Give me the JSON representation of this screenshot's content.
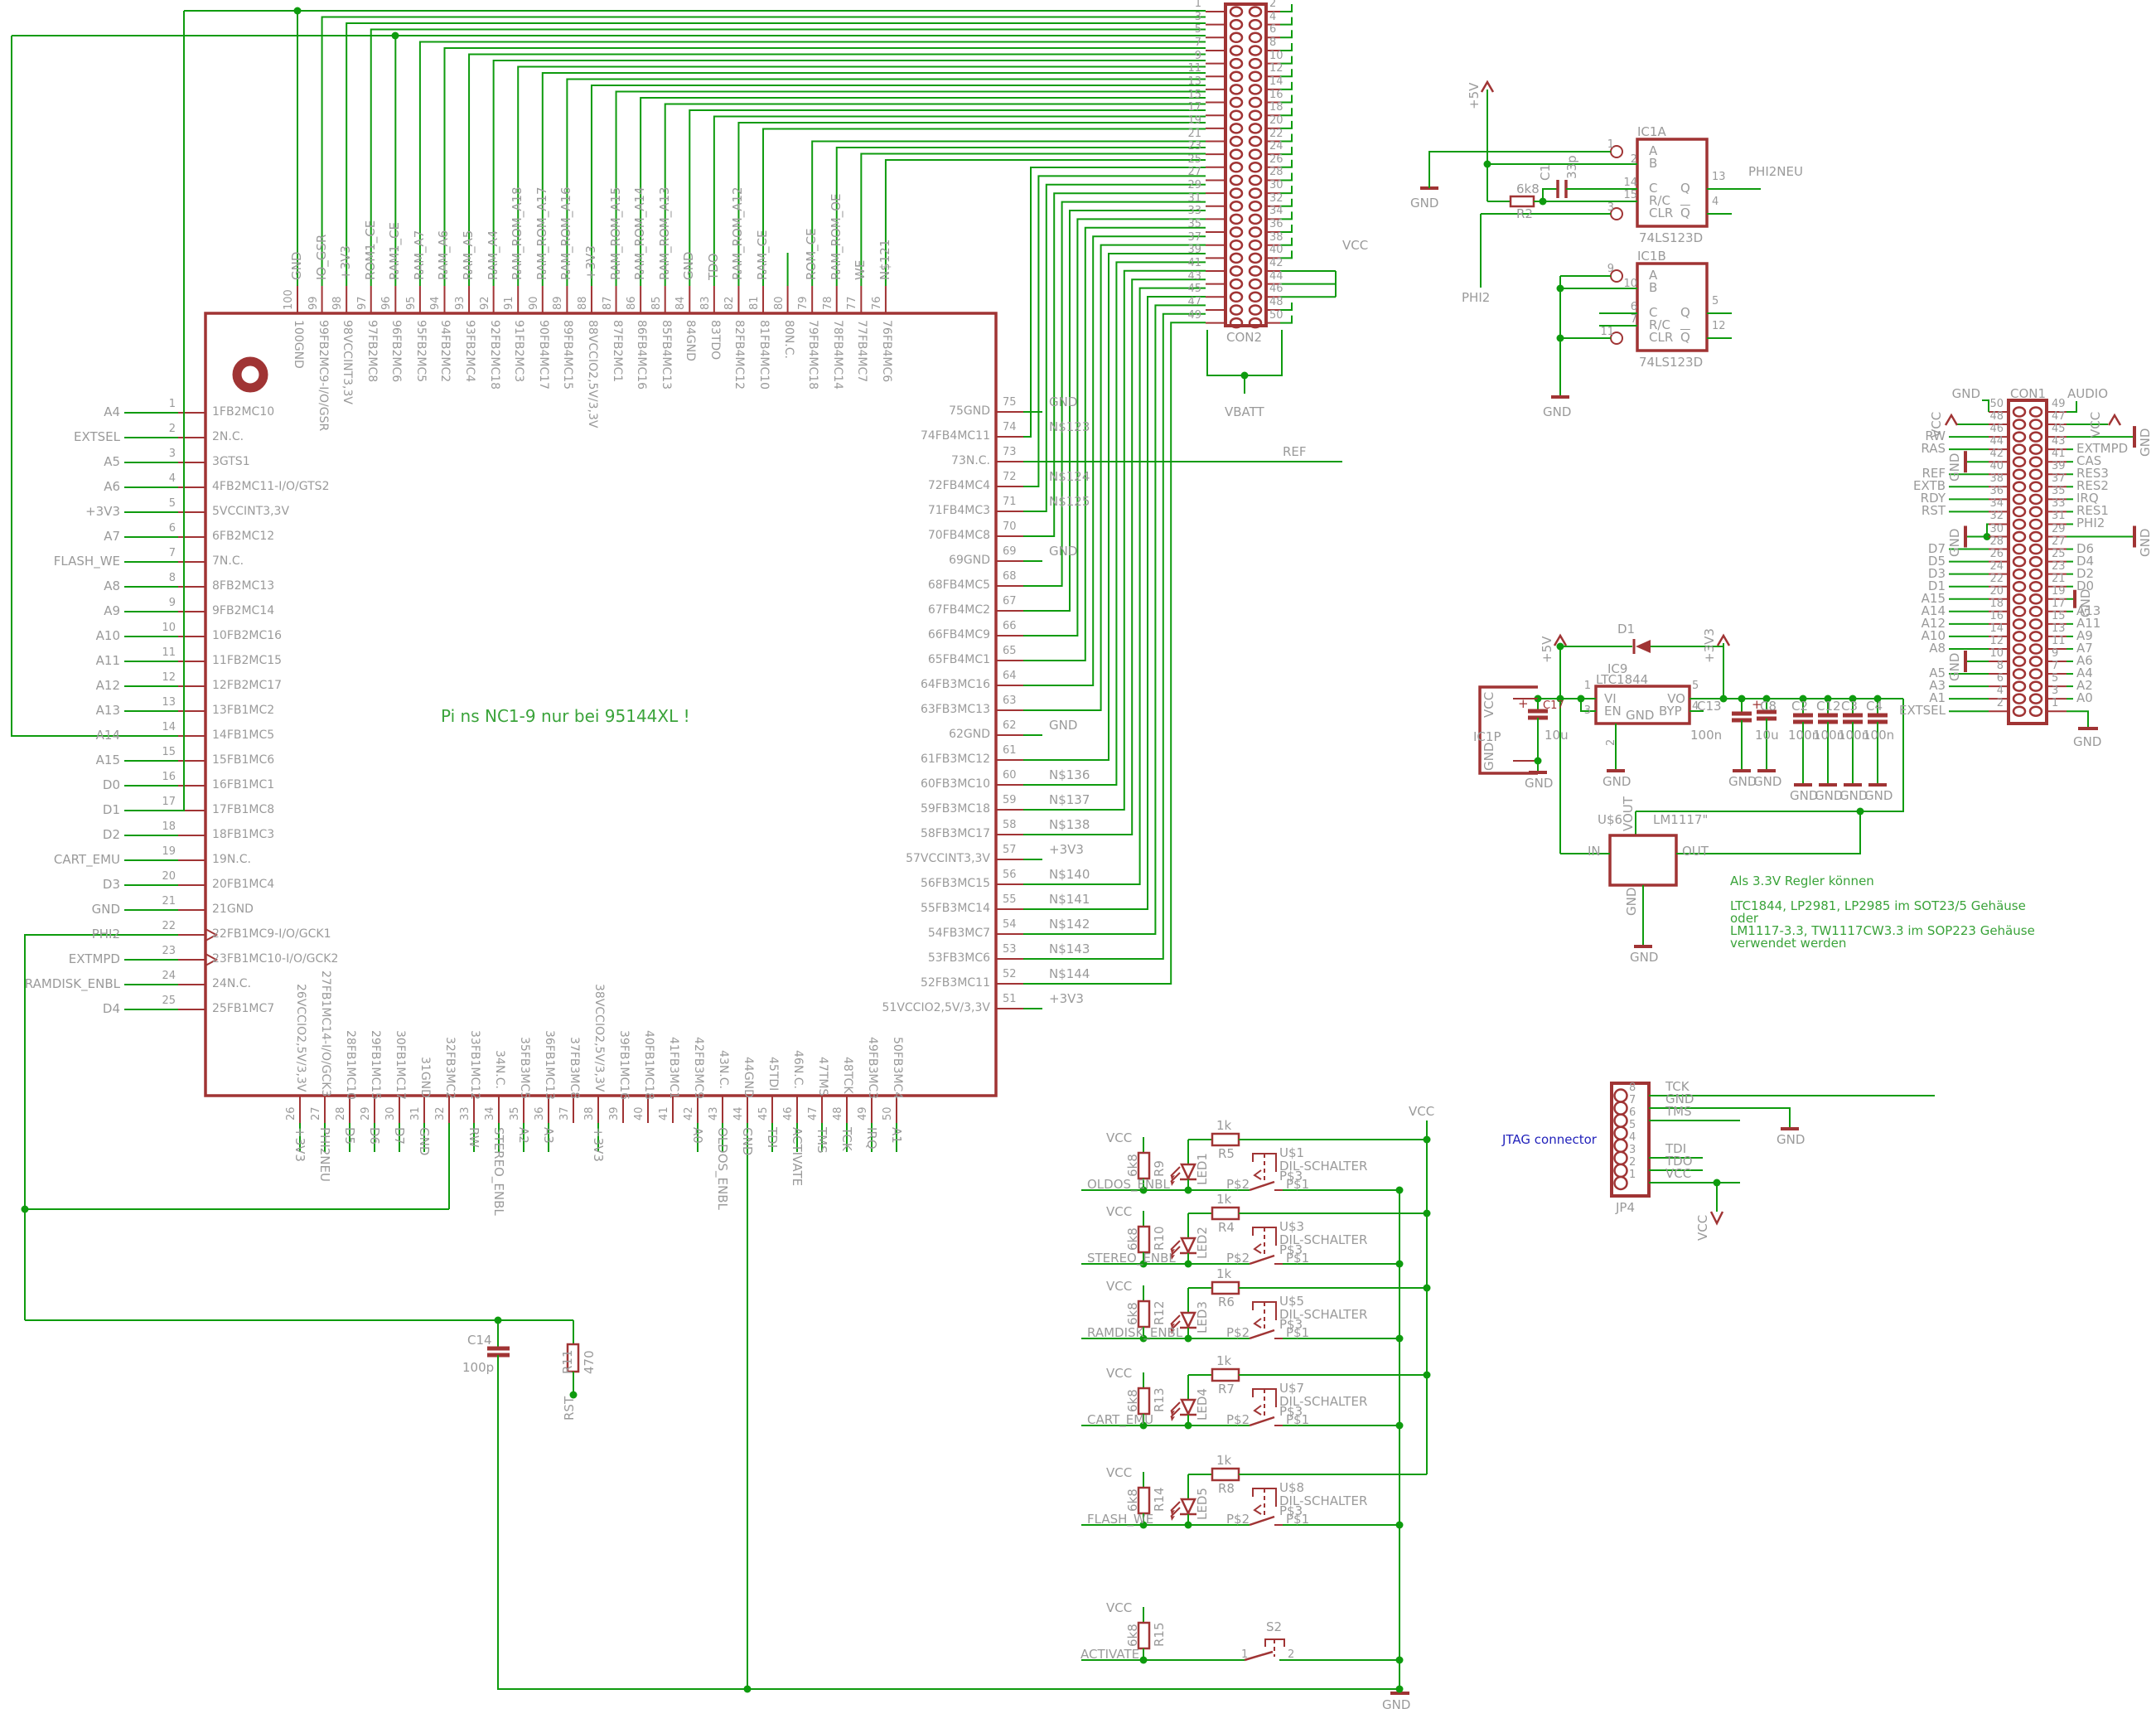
{
  "power": {
    "vcc": "VCC",
    "gnd": "GND",
    "p3v3": "+3V3",
    "p5v": "+5V",
    "vbatt": "VBATT",
    "ref": "REF"
  },
  "notes": {
    "chip": "Pi ns NC1-9 nur bei 95144XL !",
    "jtag": "JTAG connector",
    "reg1": "Als 3.3V Regler können",
    "reg2": "LTC1844, LP2981, LP2985 im SOT23/5 Gehäuse",
    "reg3": "oder",
    "reg4": "LM1117-3.3, TW1117CW3.3 im SOP223 Gehäuse",
    "reg5": "verwendet werden"
  },
  "chip": {
    "left_pins": [
      {
        "n": "1",
        "name": "1FB2MC10",
        "label": "A4"
      },
      {
        "n": "2",
        "name": "2N.C.",
        "label": "EXTSEL"
      },
      {
        "n": "3",
        "name": "3GTS1",
        "label": "A5"
      },
      {
        "n": "4",
        "name": "4FB2MC11-I/O/GTS2",
        "label": "A6"
      },
      {
        "n": "5",
        "name": "5VCCINT3,3V",
        "label": "+3V3"
      },
      {
        "n": "6",
        "name": "6FB2MC12",
        "label": "A7"
      },
      {
        "n": "7",
        "name": "7N.C.",
        "label": "FLASH_WE"
      },
      {
        "n": "8",
        "name": "8FB2MC13",
        "label": "A8"
      },
      {
        "n": "9",
        "name": "9FB2MC14",
        "label": "A9"
      },
      {
        "n": "10",
        "name": "10FB2MC16",
        "label": "A10"
      },
      {
        "n": "11",
        "name": "11FB2MC15",
        "label": "A11"
      },
      {
        "n": "12",
        "name": "12FB2MC17",
        "label": "A12"
      },
      {
        "n": "13",
        "name": "13FB1MC2",
        "label": "A13"
      },
      {
        "n": "14",
        "name": "14FB1MC5",
        "label": "A14"
      },
      {
        "n": "15",
        "name": "15FB1MC6",
        "label": "A15"
      },
      {
        "n": "16",
        "name": "16FB1MC1",
        "label": "D0"
      },
      {
        "n": "17",
        "name": "17FB1MC8",
        "label": "D1"
      },
      {
        "n": "18",
        "name": "18FB1MC3",
        "label": "D2"
      },
      {
        "n": "19",
        "name": "19N.C.",
        "label": "CART_EMU"
      },
      {
        "n": "20",
        "name": "20FB1MC4",
        "label": "D3"
      },
      {
        "n": "21",
        "name": "21GND",
        "label": "GND"
      },
      {
        "n": "22",
        "name": "22FB1MC9-I/O/GCK1",
        "label": "PHI2"
      },
      {
        "n": "23",
        "name": "23FB1MC10-I/O/GCK2",
        "label": "EXTMPD"
      },
      {
        "n": "24",
        "name": "24N.C.",
        "label": "RAMDISK_ENBL"
      },
      {
        "n": "25",
        "name": "25FB1MC7",
        "label": "D4"
      }
    ],
    "top_pins": [
      {
        "n": "100",
        "name": "100GND",
        "label": "GND"
      },
      {
        "n": "99",
        "name": "99FB2MC9-I/O/GSR",
        "label": "IO_GSR"
      },
      {
        "n": "98",
        "name": "98VCCINT3,3V",
        "label": "+3V3"
      },
      {
        "n": "97",
        "name": "97FB2MC8",
        "label": "ROM1_CE"
      },
      {
        "n": "96",
        "name": "96FB2MC6",
        "label": "RAM1_CE"
      },
      {
        "n": "95",
        "name": "95FB2MC5",
        "label": "RAM_A7"
      },
      {
        "n": "94",
        "name": "94FB2MC2",
        "label": "RAM_A6"
      },
      {
        "n": "93",
        "name": "93FB2MC4",
        "label": "RAM_A5"
      },
      {
        "n": "92",
        "name": "92FB2MC18",
        "label": "RAM_A4"
      },
      {
        "n": "91",
        "name": "91FB2MC3",
        "label": "RAM_ROM_A18"
      },
      {
        "n": "90",
        "name": "90FB4MC17",
        "label": "RAM_ROM_A17"
      },
      {
        "n": "89",
        "name": "89FB4MC15",
        "label": "RAM_ROM_A16"
      },
      {
        "n": "88",
        "name": "88VCCIO2,5V/3,3V",
        "label": "+3V3"
      },
      {
        "n": "87",
        "name": "87FB2MC1",
        "label": "RAM_ROM_A15"
      },
      {
        "n": "86",
        "name": "86FB4MC16",
        "label": "RAM_ROM_A14"
      },
      {
        "n": "85",
        "name": "85FB4MC13",
        "label": "RAM_ROM_A13"
      },
      {
        "n": "84",
        "name": "84GND",
        "label": "GND"
      },
      {
        "n": "83",
        "name": "83TDO",
        "label": "TDO"
      },
      {
        "n": "82",
        "name": "82FB4MC12",
        "label": "RAM_ROM_A12"
      },
      {
        "n": "81",
        "name": "81FB4MC10",
        "label": "RAM_CE"
      },
      {
        "n": "80",
        "name": "80N.C.",
        "label": ""
      },
      {
        "n": "79",
        "name": "79FB4MC18",
        "label": "ROM_CE"
      },
      {
        "n": "78",
        "name": "78FB4MC14",
        "label": "RAM_ROM_OE"
      },
      {
        "n": "77",
        "name": "77FB4MC7",
        "label": "WE"
      },
      {
        "n": "76",
        "name": "76FB4MC6",
        "label": "N$121"
      }
    ],
    "right_pins": [
      {
        "n": "75",
        "name": "75GND",
        "label": "GND"
      },
      {
        "n": "74",
        "name": "74FB4MC11",
        "label": "N$123"
      },
      {
        "n": "73",
        "name": "73N.C.",
        "label": "REF"
      },
      {
        "n": "72",
        "name": "72FB4MC4",
        "label": "N$124"
      },
      {
        "n": "71",
        "name": "71FB4MC3",
        "label": "N$125"
      },
      {
        "n": "70",
        "name": "70FB4MC8",
        "label": ""
      },
      {
        "n": "69",
        "name": "69GND",
        "label": "GND"
      },
      {
        "n": "68",
        "name": "68FB4MC5",
        "label": ""
      },
      {
        "n": "67",
        "name": "67FB4MC2",
        "label": ""
      },
      {
        "n": "66",
        "name": "66FB4MC9",
        "label": ""
      },
      {
        "n": "65",
        "name": "65FB4MC1",
        "label": ""
      },
      {
        "n": "64",
        "name": "64FB3MC16",
        "label": ""
      },
      {
        "n": "63",
        "name": "63FB3MC13",
        "label": ""
      },
      {
        "n": "62",
        "name": "62GND",
        "label": "GND"
      },
      {
        "n": "61",
        "name": "61FB3MC12",
        "label": ""
      },
      {
        "n": "60",
        "name": "60FB3MC10",
        "label": "N$136"
      },
      {
        "n": "59",
        "name": "59FB3MC18",
        "label": "N$137"
      },
      {
        "n": "58",
        "name": "58FB3MC17",
        "label": "N$138"
      },
      {
        "n": "57",
        "name": "57VCCINT3,3V",
        "label": "+3V3"
      },
      {
        "n": "56",
        "name": "56FB3MC15",
        "label": "N$140"
      },
      {
        "n": "55",
        "name": "55FB3MC14",
        "label": "N$141"
      },
      {
        "n": "54",
        "name": "54FB3MC7",
        "label": "N$142"
      },
      {
        "n": "53",
        "name": "53FB3MC6",
        "label": "N$143"
      },
      {
        "n": "52",
        "name": "52FB3MC11",
        "label": "N$144"
      },
      {
        "n": "51",
        "name": "51VCCIO2,5V/3,3V",
        "label": "+3V3"
      }
    ],
    "bottom_pins": [
      {
        "n": "26",
        "name": "26VCCIO2,5V/3,3V",
        "label": "+3V3"
      },
      {
        "n": "27",
        "name": "27FB1MC14-I/O/GCK3",
        "label": "PHI2NEU"
      },
      {
        "n": "28",
        "name": "28FB1MC10",
        "label": "D5"
      },
      {
        "n": "29",
        "name": "29FB1MC15",
        "label": "D6"
      },
      {
        "n": "30",
        "name": "30FB1MC17",
        "label": "D7"
      },
      {
        "n": "31",
        "name": "31GND",
        "label": "GND"
      },
      {
        "n": "32",
        "name": "32FB3MC2",
        "label": ""
      },
      {
        "n": "33",
        "name": "33FB1MC12",
        "label": "RW"
      },
      {
        "n": "34",
        "name": "34N.C.",
        "label": "STEREO_ENBL"
      },
      {
        "n": "35",
        "name": "35FB3MC5",
        "label": "A2"
      },
      {
        "n": "36",
        "name": "36FB1MC13",
        "label": "A3"
      },
      {
        "n": "37",
        "name": "37FB3MC8",
        "label": ""
      },
      {
        "n": "38",
        "name": "38VCCIO2,5V/3,3V",
        "label": "+3V3"
      },
      {
        "n": "39",
        "name": "39FB1MC16",
        "label": ""
      },
      {
        "n": "40",
        "name": "40FB1MC18",
        "label": ""
      },
      {
        "n": "41",
        "name": "41FB3MC1",
        "label": ""
      },
      {
        "n": "42",
        "name": "42FB3MC9",
        "label": "A0"
      },
      {
        "n": "43",
        "name": "43N.C.",
        "label": "OLDOS_ENBL"
      },
      {
        "n": "44",
        "name": "44GND",
        "label": "GND"
      },
      {
        "n": "45",
        "name": "45TDI",
        "label": "TDI"
      },
      {
        "n": "46",
        "name": "46N.C.",
        "label": "ACTIVATE"
      },
      {
        "n": "47",
        "name": "47TMS",
        "label": "TMS"
      },
      {
        "n": "48",
        "name": "48TCK",
        "label": "TCK"
      },
      {
        "n": "49",
        "name": "49FB3MC3",
        "label": "IRQ"
      },
      {
        "n": "50",
        "name": "50FB3MC4",
        "label": "A1"
      }
    ]
  },
  "con2": {
    "title": "CON2",
    "left_nums": [
      "1",
      "3",
      "5",
      "7",
      "9",
      "11",
      "13",
      "15",
      "17",
      "19",
      "21",
      "23",
      "25",
      "27",
      "29",
      "31",
      "33",
      "35",
      "37",
      "39",
      "41",
      "43",
      "45",
      "47",
      "49"
    ],
    "right_nums": [
      "2",
      "4",
      "6",
      "8",
      "10",
      "12",
      "14",
      "16",
      "18",
      "20",
      "22",
      "24",
      "26",
      "28",
      "30",
      "32",
      "34",
      "36",
      "38",
      "40",
      "42",
      "44",
      "46",
      "48",
      "50"
    ]
  },
  "con1": {
    "title": "CON1",
    "rows": [
      {
        "ln": "50",
        "ll": "GND",
        "lt": "bracket",
        "rn": "49",
        "rl": "AUDIO",
        "rt": "bracket"
      },
      {
        "ln": "48",
        "ll": "VCC",
        "lt": "vcc",
        "rn": "47",
        "rl": "VCC",
        "rt": "vcc"
      },
      {
        "ln": "46",
        "ll": "RW",
        "lt": "",
        "rn": "45",
        "rl": "GND",
        "rt": "gndbar"
      },
      {
        "ln": "44",
        "ll": "RAS",
        "lt": "",
        "rn": "43",
        "rl": "EXTMPD",
        "rt": ""
      },
      {
        "ln": "42",
        "ll": "GND",
        "lt": "gndbar",
        "rn": "41",
        "rl": "CAS",
        "rt": ""
      },
      {
        "ln": "40",
        "ll": "REF",
        "lt": "",
        "rn": "39",
        "rl": "RES3",
        "rt": ""
      },
      {
        "ln": "38",
        "ll": "EXTB",
        "lt": "",
        "rn": "37",
        "rl": "RES2",
        "rt": ""
      },
      {
        "ln": "36",
        "ll": "RDY",
        "lt": "",
        "rn": "35",
        "rl": "IRQ",
        "rt": ""
      },
      {
        "ln": "34",
        "ll": "RST",
        "lt": "",
        "rn": "33",
        "rl": "RES1",
        "rt": ""
      },
      {
        "ln": "32",
        "ll": "",
        "lt": "hook",
        "rn": "31",
        "rl": "PHI2",
        "rt": ""
      },
      {
        "ln": "30",
        "ll": "GND",
        "lt": "gndbar",
        "rn": "29",
        "rl": "GND",
        "rt": "gndbar"
      },
      {
        "ln": "28",
        "ll": "D7",
        "lt": "",
        "rn": "27",
        "rl": "D6",
        "rt": ""
      },
      {
        "ln": "26",
        "ll": "D5",
        "lt": "",
        "rn": "25",
        "rl": "D4",
        "rt": ""
      },
      {
        "ln": "24",
        "ll": "D3",
        "lt": "",
        "rn": "23",
        "rl": "D2",
        "rt": ""
      },
      {
        "ln": "22",
        "ll": "D1",
        "lt": "",
        "rn": "21",
        "rl": "D0",
        "rt": ""
      },
      {
        "ln": "20",
        "ll": "A15",
        "lt": "",
        "rn": "19",
        "rl": "GND",
        "rt": "gndsmall"
      },
      {
        "ln": "18",
        "ll": "A14",
        "lt": "",
        "rn": "17",
        "rl": "A13",
        "rt": ""
      },
      {
        "ln": "16",
        "ll": "A12",
        "lt": "",
        "rn": "15",
        "rl": "A11",
        "rt": ""
      },
      {
        "ln": "14",
        "ll": "A10",
        "lt": "",
        "rn": "13",
        "rl": "A9",
        "rt": ""
      },
      {
        "ln": "12",
        "ll": "A8",
        "lt": "",
        "rn": "11",
        "rl": "A7",
        "rt": ""
      },
      {
        "ln": "10",
        "ll": "GND",
        "lt": "gndbar",
        "rn": "9",
        "rl": "A6",
        "rt": ""
      },
      {
        "ln": "8",
        "ll": "A5",
        "lt": "",
        "rn": "7",
        "rl": "A4",
        "rt": ""
      },
      {
        "ln": "6",
        "ll": "A3",
        "lt": "",
        "rn": "5",
        "rl": "A2",
        "rt": ""
      },
      {
        "ln": "4",
        "ll": "A1",
        "lt": "",
        "rn": "3",
        "rl": "A0",
        "rt": ""
      },
      {
        "ln": "2",
        "ll": "EXTSEL",
        "lt": "",
        "rn": "1",
        "rl": "GND",
        "rt": "gnddown"
      }
    ]
  },
  "ic1a": {
    "ref": "IC1A",
    "part": "74LS123D",
    "out_label": "PHI2NEU",
    "phi2": "PHI2",
    "a": "A",
    "b": "B",
    "c": "C",
    "rc": "R/C",
    "clr": "CLR",
    "q": "Q",
    "qb": "Q",
    "na": "1",
    "nb": "2",
    "nc": "14",
    "nrc": "15",
    "nclr": "3",
    "nq": "13",
    "nqb": "4",
    "r2": "R2",
    "r2v": "6k8",
    "c1": "C1",
    "c1v": "33p"
  },
  "ic1b": {
    "ref": "IC1B",
    "part": "74LS123D",
    "a": "A",
    "b": "B",
    "c": "C",
    "rc": "R/C",
    "clr": "CLR",
    "q": "Q",
    "qb": "Q",
    "na": "9",
    "nb": "10",
    "nc": "6",
    "nrc": "7",
    "nclr": "11",
    "nq": "5",
    "nqb": "12"
  },
  "reg": {
    "ic9": "IC9",
    "part": "LTC1844",
    "vi": "VI",
    "en": "EN",
    "gnd": "GND",
    "vo": "VO",
    "byp": "BYP",
    "n1": "1",
    "n3": "3",
    "n2": "2",
    "n5": "5",
    "n4": "4",
    "d1": "D1",
    "ic1p": "IC1P",
    "c17": "C17",
    "c17v": "10u",
    "c13": "C13",
    "c13v": "100n",
    "cpol": "C8",
    "cpolv": "10u",
    "caps": [
      {
        "r": "C2",
        "v": "100n"
      },
      {
        "r": "C12",
        "v": "100n"
      },
      {
        "r": "C3",
        "v": "100n"
      },
      {
        "r": "C4",
        "v": "100n"
      }
    ],
    "u6": "U$6",
    "lm": "LM1117\"",
    "vout": "VOUT",
    "pin": "IN",
    "pout": "OUT"
  },
  "jtag": {
    "ref": "JP4",
    "pins": [
      {
        "n": "8",
        "l": "TCK"
      },
      {
        "n": "7",
        "l": "GND"
      },
      {
        "n": "6",
        "l": "TMS"
      },
      {
        "n": "5",
        "l": ""
      },
      {
        "n": "4",
        "l": ""
      },
      {
        "n": "3",
        "l": "TDI"
      },
      {
        "n": "2",
        "l": "TDO"
      },
      {
        "n": "1",
        "l": "VCC"
      }
    ]
  },
  "dip": {
    "part": "DIL-SCHALTER",
    "p1": "P$1",
    "p2": "P$2",
    "p3": "P$3"
  },
  "led_rows": [
    {
      "net": "OLDOS_ENBL",
      "pull": "R9",
      "pullv": "6k8",
      "led": "LED1",
      "series": "R5",
      "seriesv": "1k",
      "sw": "U$1"
    },
    {
      "net": "STEREO_ENBL",
      "pull": "R10",
      "pullv": "6k8",
      "led": "LED2",
      "series": "R4",
      "seriesv": "1k",
      "sw": "U$3"
    },
    {
      "net": "RAMDISK_ENBL",
      "pull": "R12",
      "pullv": "6k8",
      "led": "LED3",
      "series": "R6",
      "seriesv": "1k",
      "sw": "U$5"
    },
    {
      "net": "CART_EMU",
      "pull": "R13",
      "pullv": "6k8",
      "led": "LED4",
      "series": "R7",
      "seriesv": "1k",
      "sw": "U$7"
    },
    {
      "net": "FLASH_WE",
      "pull": "R14",
      "pullv": "6k8",
      "led": "LED5",
      "series": "R8",
      "seriesv": "1k",
      "sw": "U$8"
    }
  ],
  "activate_row": {
    "net": "ACTIVATE",
    "pull": "R15",
    "pullv": "6k8",
    "sw": "S2",
    "c1": "1",
    "c2": "2"
  },
  "bottom_left": {
    "c14": "C14",
    "c14v": "100p",
    "r11": "R11",
    "r11v": "470",
    "rst": "RST"
  }
}
